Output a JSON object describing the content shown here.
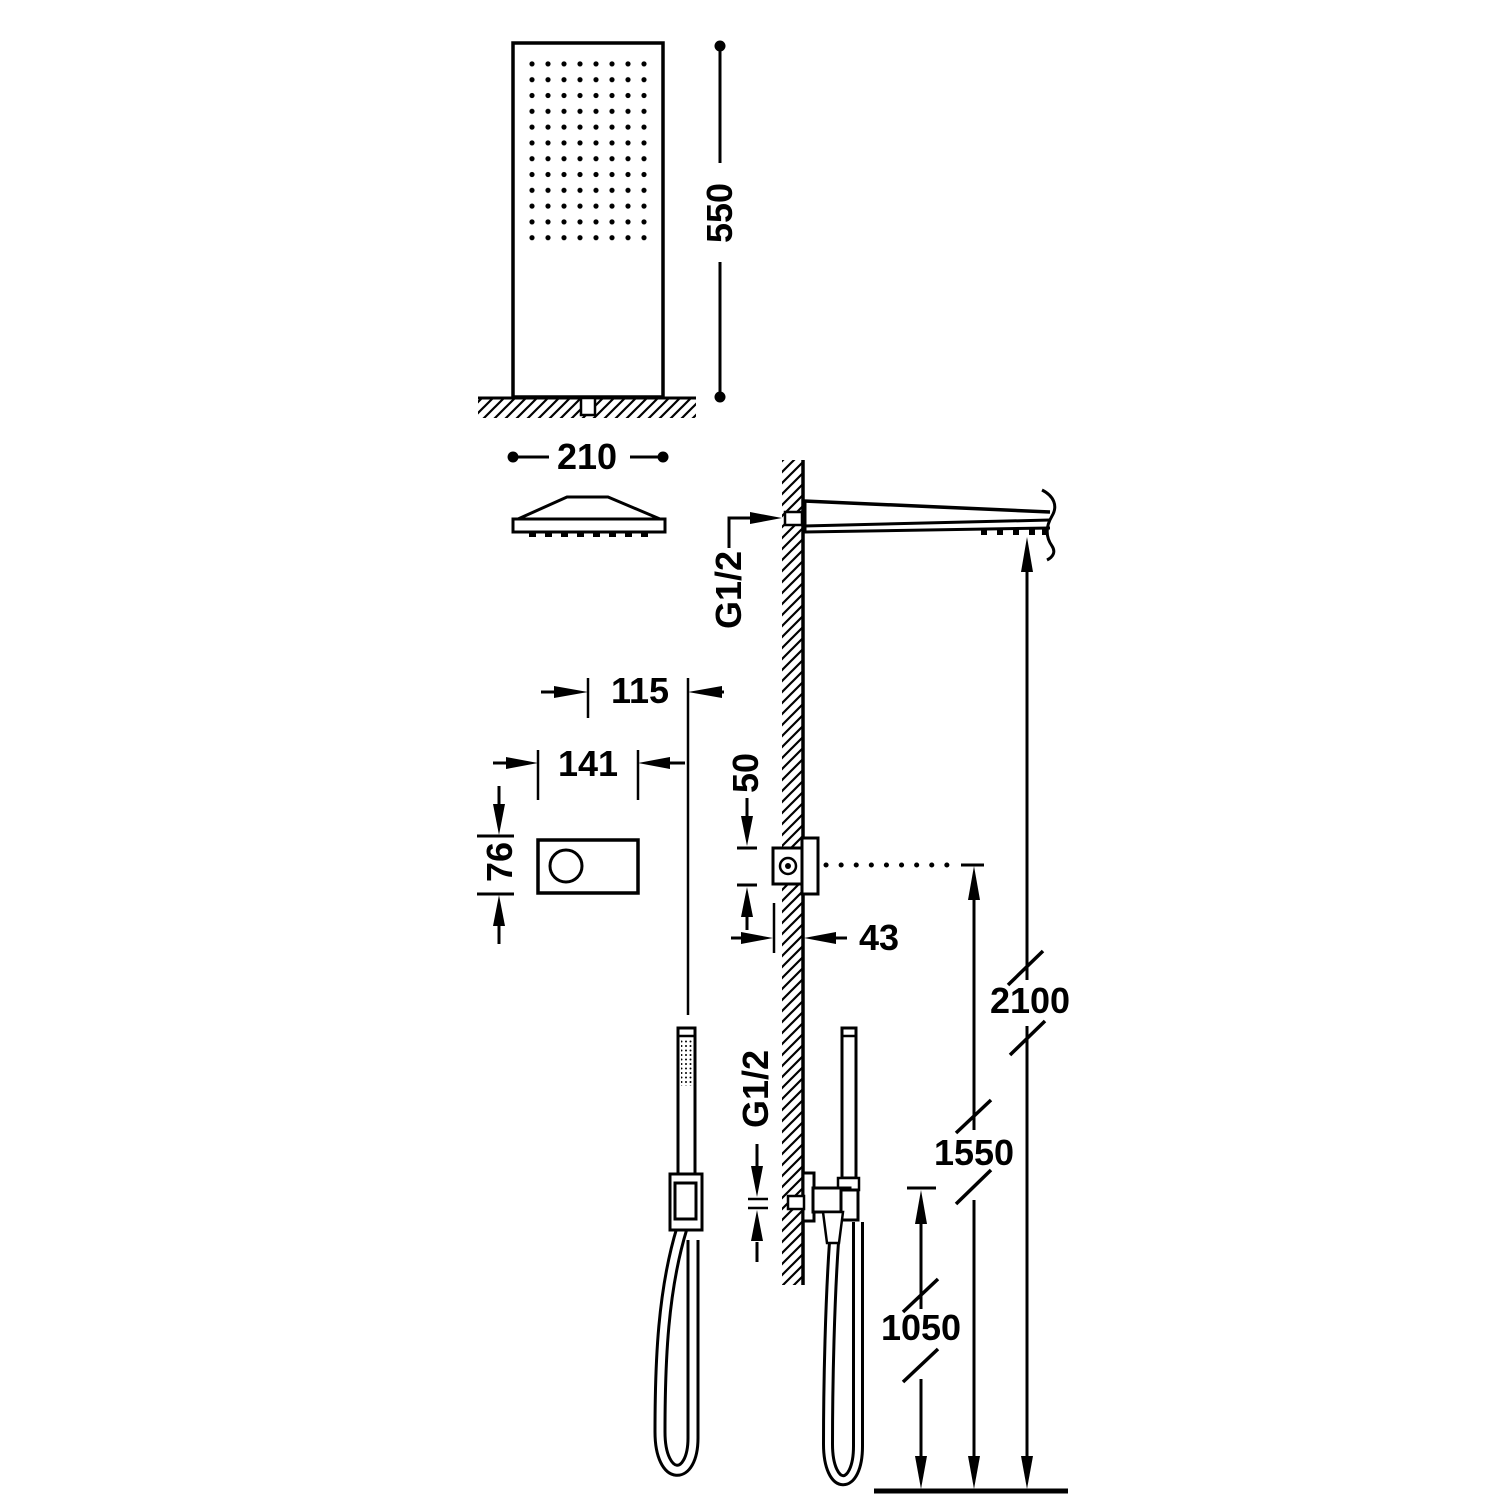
{
  "diagram": {
    "background": "#ffffff",
    "line_color": "#000000",
    "labels": {
      "shower_head_height": "550",
      "shower_head_width": "210",
      "control_center_offset": "115",
      "control_plate_width": "141",
      "control_plate_height": "76",
      "control_body_height": "50",
      "control_body_depth": "43",
      "shower_arm_thread": "G1/2",
      "hand_shower_outlet_thread": "G1/2",
      "shower_arm_height_from_floor": "2100",
      "control_height_from_floor": "1550",
      "hand_shower_height_from_floor": "1050"
    }
  }
}
